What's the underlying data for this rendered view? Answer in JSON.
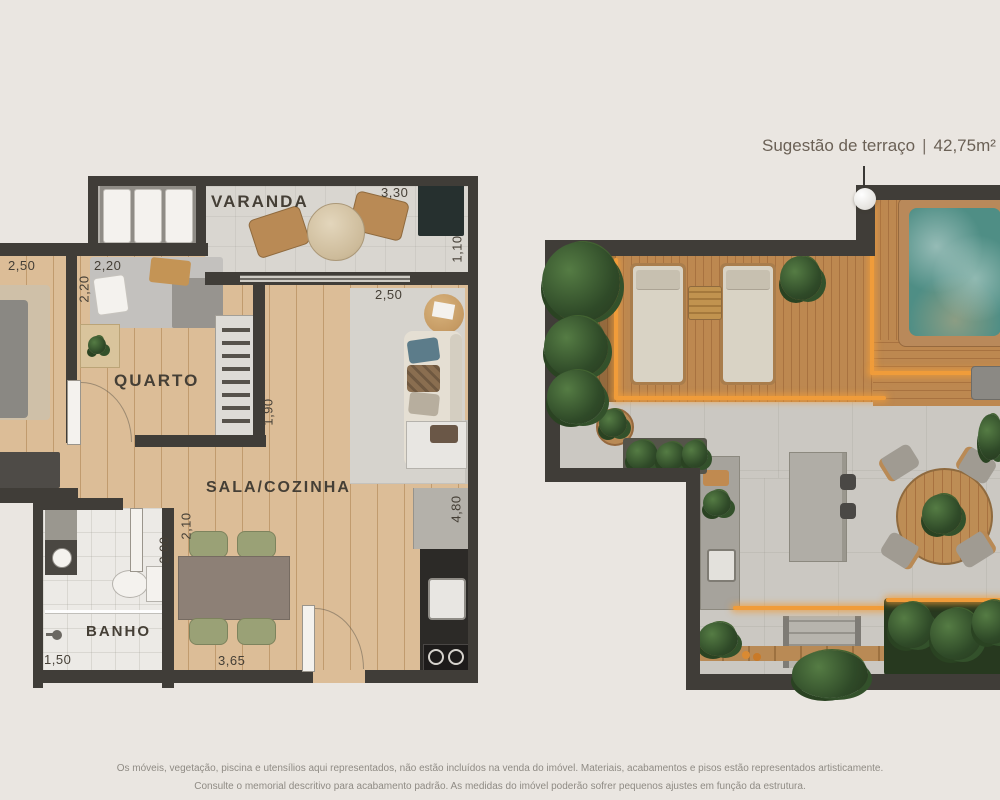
{
  "title": {
    "text": "Sugestão de terraço",
    "separator": "|",
    "area": "42,75m²"
  },
  "apartment_plan": {
    "rooms": {
      "varanda": "VARANDA",
      "quarto": "QUARTO",
      "sala_cozinha": "SALA/COZINHA",
      "banho": "BANHO"
    },
    "measurements": {
      "adjacent_room_width": "2,50",
      "quarto_width": "2,20",
      "quarto_depth": "2,20",
      "quarto_wardrobe_side": "1,90",
      "varanda_width": "3,30",
      "varanda_depth": "1,10",
      "sala_width": "2,50",
      "banho_side_a": "2,10",
      "banho_side_b": "2,00",
      "banho_width": "1,50",
      "sala_length": "3,65",
      "cozinha_depth": "4,80"
    }
  },
  "disclaimer": {
    "line1": "Os móveis, vegetação, piscina e utensílios aqui representados, não estão incluídos na venda do imóvel. Materiais, acabamentos e pisos estão representados artisticamente.",
    "line2": "Consulte o memorial descritivo para acabamento padrão. As medidas do imóvel poderão sofrer pequenos ajustes em função da estrutura."
  },
  "colors": {
    "bg": "#eae6e1",
    "wall": "#403d38",
    "wood": "#dcbd97",
    "tile": "#d9d6d0",
    "bath": "#eceae6",
    "deck": "#bd8850",
    "concrete": "#cbc8c2",
    "water": "#4f8e85",
    "glow": "#f09c3a",
    "plant": "#3c5a33",
    "text": "#453f36",
    "title_text": "#6b6156",
    "footer_text": "#8f8b84"
  }
}
